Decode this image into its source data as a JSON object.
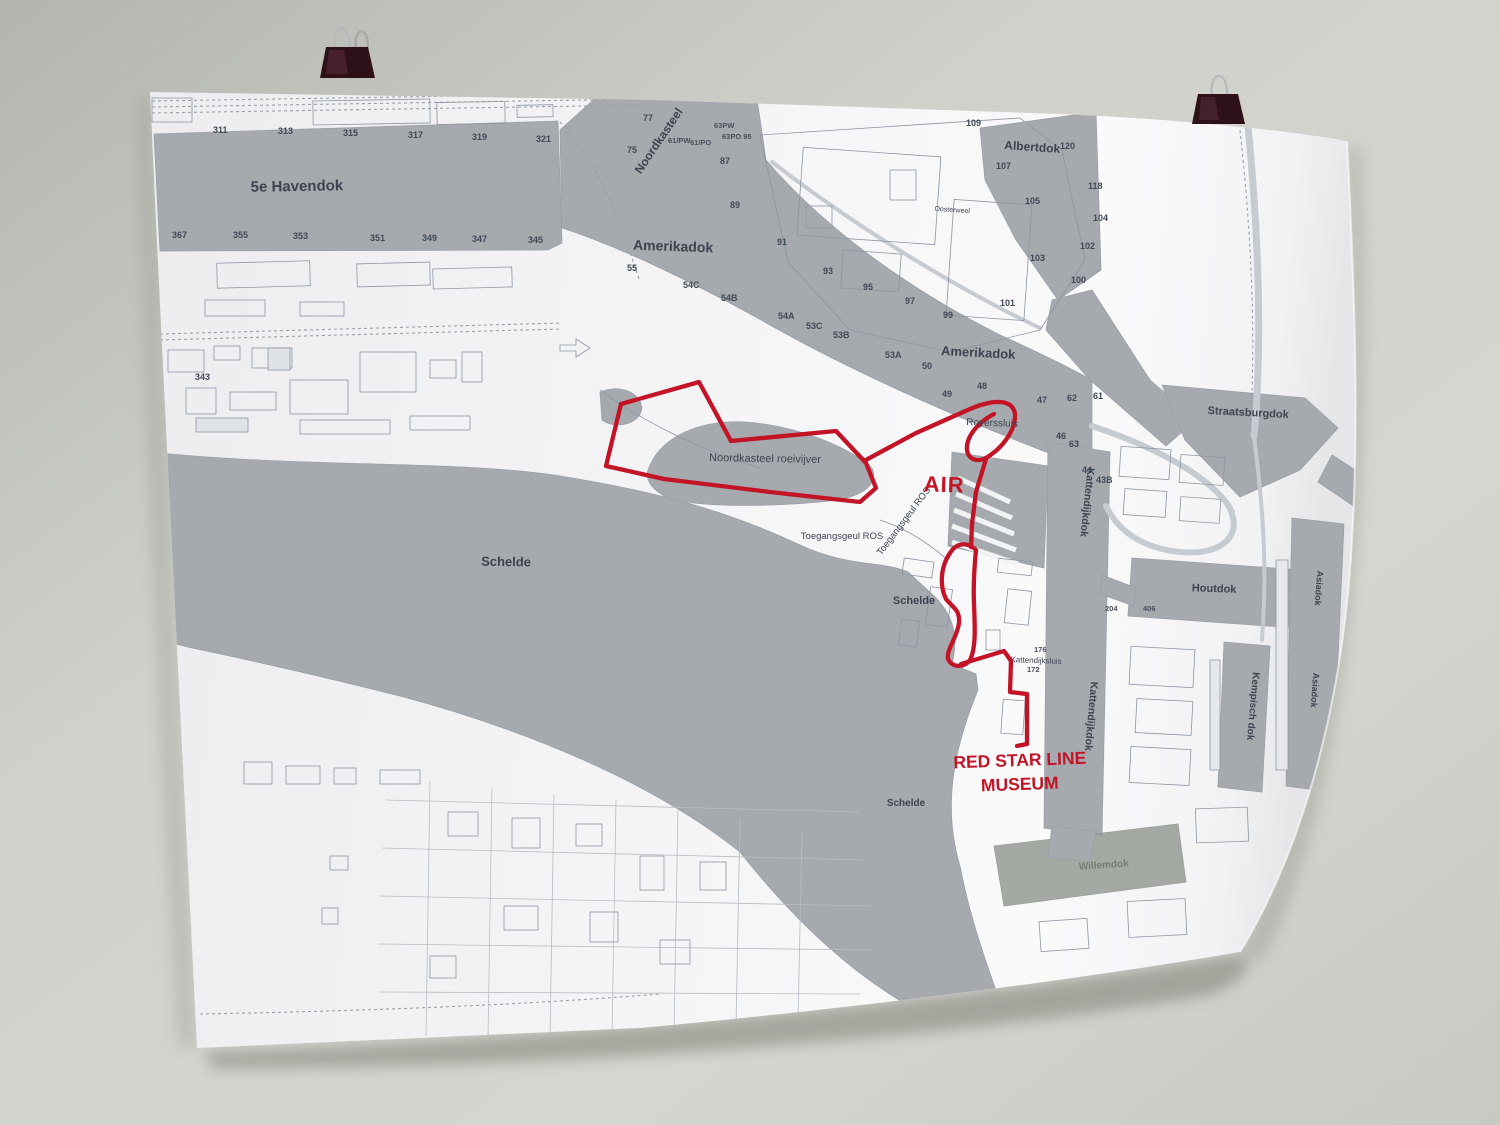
{
  "scene": {
    "wall_color": "#cdcec8",
    "poster_color": "#f3f3f5",
    "water_color": "#a6aaae",
    "route_color": "#c31326",
    "label_color": "#3d4450",
    "clip_color": "#2e1018"
  },
  "map": {
    "labels": {
      "havendok5": "5e Havendok",
      "amerikadok_upper": "Amerikadok",
      "amerikadok_lower": "Amerikadok",
      "albertdok": "Albertdok",
      "noordkasteel": "Noordkasteel",
      "oosterweel": "Oosterweel",
      "straatsburgdok": "Straatsburgdok",
      "albertkanaal": "Albertkanaal",
      "roeivijver": "Noordkasteel roeivijver",
      "royerssluis": "Royerssluis",
      "toegangsgeul_h": "Toegangsgeul ROS",
      "toegangsgeul_d": "Toegangsgeul ROS",
      "schelde_1": "Schelde",
      "schelde_2": "Schelde",
      "schelde_3": "Schelde",
      "kattendijkdok_1": "Kattendijkdok",
      "kattendijkdok_2": "Kattendijkdok",
      "kattendijksluis": "Kattendijksluis",
      "houtdok": "Houtdok",
      "kempischdok": "Kempisch dok",
      "asiadok_1": "Asiadok",
      "asiadok_2": "Asiadok",
      "willemdok": "Willemdok"
    },
    "red_labels": {
      "air": "AIR",
      "museum_1": "RED STAR LINE",
      "museum_2": "MUSEUM"
    },
    "numbers": {
      "n311": "311",
      "n313": "313",
      "n315": "315",
      "n317": "317",
      "n319": "319",
      "n321": "321",
      "n367": "367",
      "n355": "355",
      "n353": "353",
      "n351": "351",
      "n349": "349",
      "n347": "347",
      "n345": "345",
      "n343": "343",
      "n77": "77",
      "n75": "75",
      "n61pw": "61/PW",
      "n61po": "61/PO",
      "n63pw": "63PW",
      "n63po95": "63PO 95",
      "n87": "87",
      "n89": "89",
      "n91": "91",
      "n93": "93",
      "n95": "95",
      "n97": "97",
      "n99": "99",
      "n101": "101",
      "n103": "103",
      "n105": "105",
      "n107": "107",
      "n109": "109",
      "n55": "55",
      "n54c": "54C",
      "n54b": "54B",
      "n54a": "54A",
      "n53c": "53C",
      "n53b": "53B",
      "n53a": "53A",
      "n50": "50",
      "n49": "49",
      "n48": "48",
      "n47": "47",
      "n62": "62",
      "n61b": "61",
      "n46": "46",
      "n63b": "63",
      "n44": "44",
      "n43b": "43B",
      "n120": "120",
      "n118": "118",
      "n104": "104",
      "n102": "102",
      "n100": "100",
      "n176": "176",
      "n172": "172",
      "n204": "204",
      "n406": "406"
    }
  }
}
